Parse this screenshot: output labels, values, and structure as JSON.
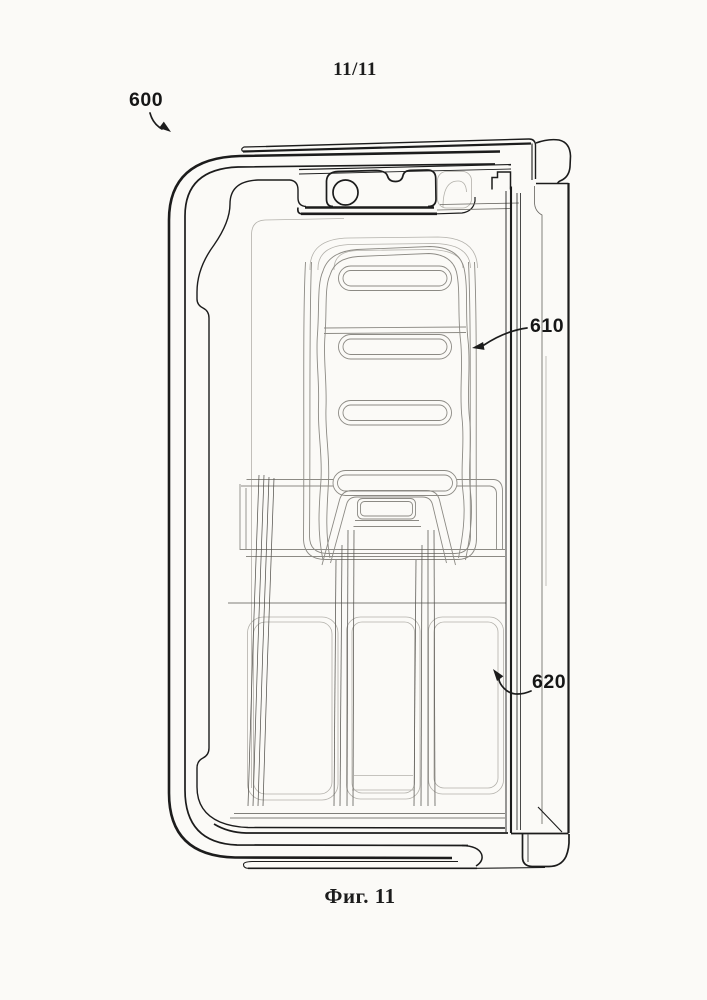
{
  "page": {
    "sheet_number": "11/11",
    "figure_caption": "Фиг. 11"
  },
  "figure": {
    "reference_numerals": {
      "label_600": "600",
      "label_610": "610",
      "label_620": "620"
    },
    "colors": {
      "paper": "#fbfaf7",
      "ink": "#1c1c1c",
      "light_line": "#8c8a84",
      "ghost_line": "#b3b1ab"
    }
  }
}
